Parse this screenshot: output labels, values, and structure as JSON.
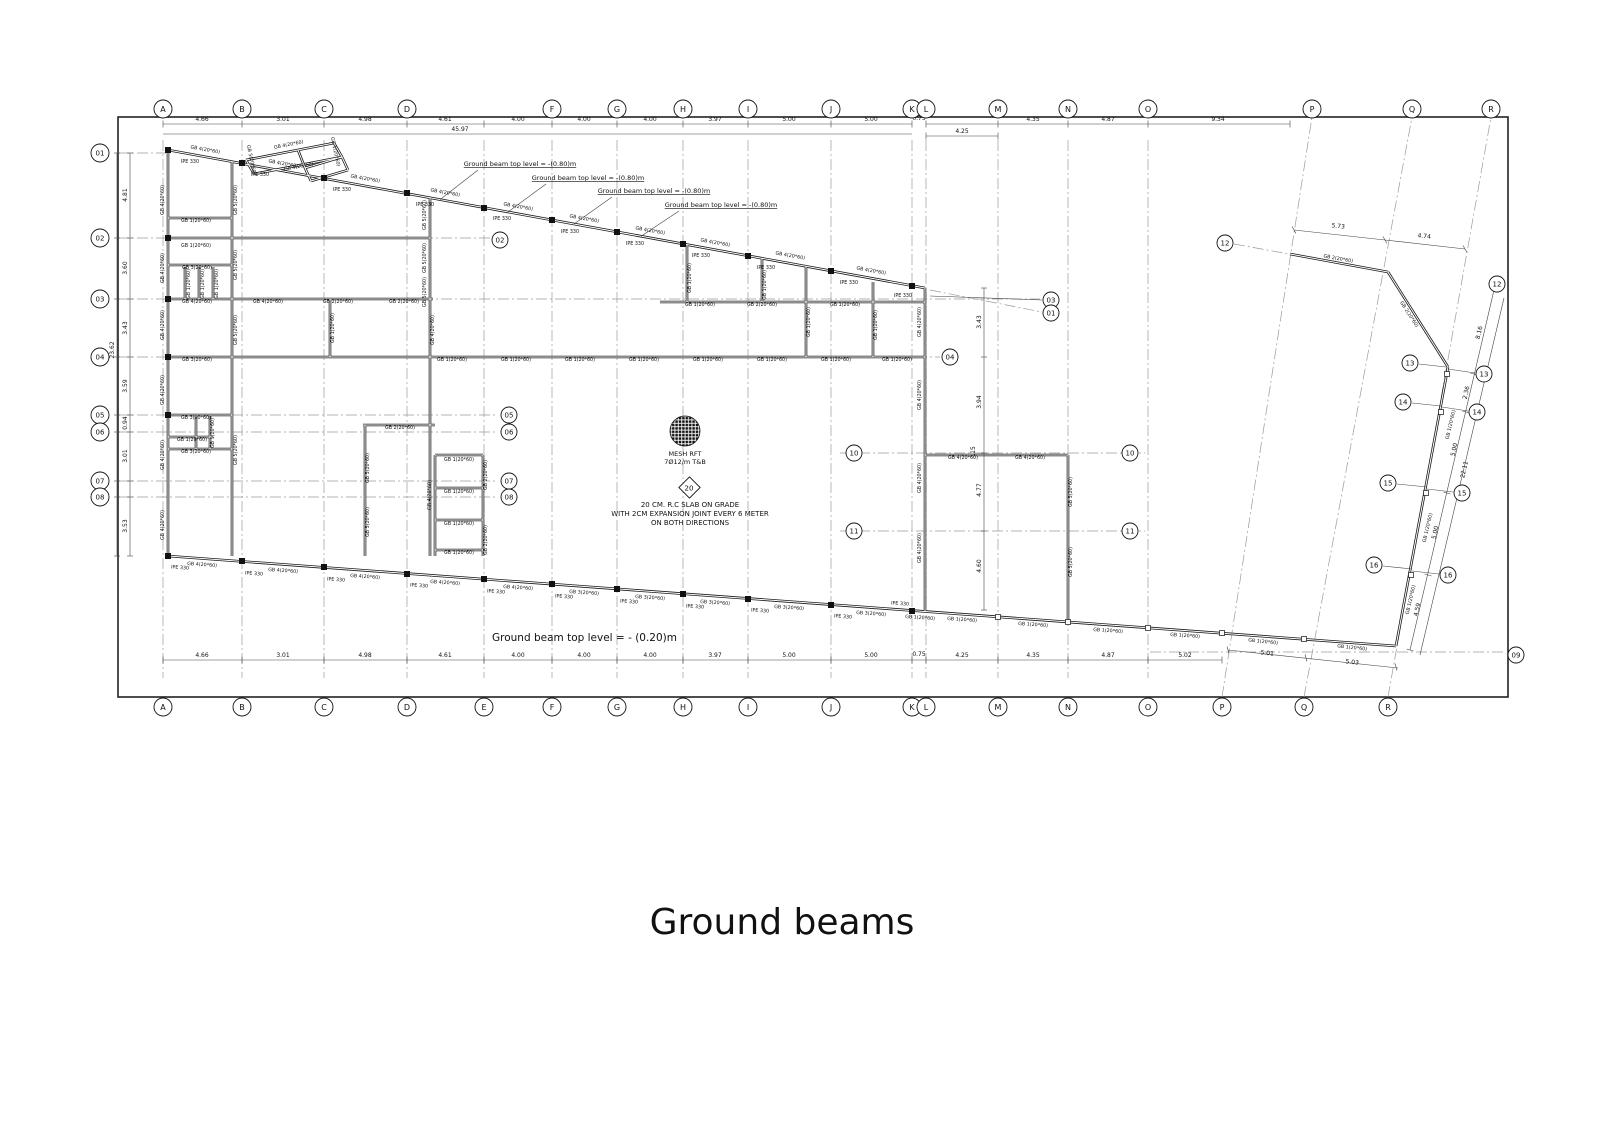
{
  "title": "Ground beams",
  "notes": {
    "top_level_note": "Ground beam top level = -(0.80)m",
    "top_level_note_positions": [
      [
        520,
        166
      ],
      [
        588,
        180
      ],
      [
        654,
        193
      ],
      [
        721,
        207
      ]
    ],
    "bottom_level_note": "Ground beam top level = - (0.20)m",
    "mesh_line1": "MESH RFT",
    "mesh_line2": "7Ø12/m T&B",
    "slab_marker": "20",
    "slab_line1": "20 CM. R.C SLAB ON GRADE",
    "slab_line2": "WITH 2CM EXPANSION JOINT EVERY 6 METER",
    "slab_line3": "ON BOTH DIRECTIONS"
  },
  "grid": {
    "cols_top": [
      [
        "A",
        163
      ],
      [
        "B",
        242
      ],
      [
        "C",
        324
      ],
      [
        "D",
        407
      ],
      [
        "F",
        552
      ],
      [
        "G",
        617
      ],
      [
        "H",
        683
      ],
      [
        "I",
        748
      ],
      [
        "J",
        831
      ],
      [
        "K",
        912
      ],
      [
        "L",
        926
      ],
      [
        "M",
        998
      ],
      [
        "N",
        1068
      ],
      [
        "O",
        1148
      ],
      [
        "P",
        1312
      ],
      [
        "Q",
        1412
      ],
      [
        "R",
        1491
      ]
    ],
    "cols_bottom": [
      [
        "A",
        163
      ],
      [
        "B",
        242
      ],
      [
        "C",
        324
      ],
      [
        "D",
        407
      ],
      [
        "E",
        484
      ],
      [
        "F",
        552
      ],
      [
        "G",
        617
      ],
      [
        "H",
        683
      ],
      [
        "I",
        748
      ],
      [
        "J",
        831
      ],
      [
        "K",
        912
      ],
      [
        "L",
        926
      ],
      [
        "M",
        998
      ],
      [
        "N",
        1068
      ],
      [
        "O",
        1148
      ],
      [
        "P",
        1222
      ],
      [
        "Q",
        1304
      ],
      [
        "R",
        1388
      ]
    ],
    "rows_left": [
      [
        "01",
        153
      ],
      [
        "02",
        238
      ],
      [
        "03",
        299
      ],
      [
        "04",
        357
      ],
      [
        "05",
        415
      ],
      [
        "06",
        432
      ],
      [
        "07",
        481
      ],
      [
        "08",
        497
      ]
    ],
    "bubbles": [
      [
        "02",
        500,
        240
      ],
      [
        "05",
        509,
        415
      ],
      [
        "06",
        509,
        432
      ],
      [
        "07",
        509,
        481
      ],
      [
        "08",
        509,
        497
      ],
      [
        "03",
        1051,
        300
      ],
      [
        "01",
        1051,
        313
      ],
      [
        "04",
        950,
        357
      ],
      [
        "10",
        854,
        453
      ],
      [
        "10",
        1130,
        453
      ],
      [
        "11",
        854,
        531
      ],
      [
        "11",
        1130,
        531
      ],
      [
        "12",
        1225,
        243
      ],
      [
        "12",
        1497,
        284
      ],
      [
        "13",
        1410,
        363
      ],
      [
        "13",
        1484,
        374
      ],
      [
        "14",
        1403,
        402
      ],
      [
        "14",
        1477,
        412
      ],
      [
        "15",
        1388,
        483
      ],
      [
        "15",
        1462,
        493
      ],
      [
        "16",
        1374,
        565
      ],
      [
        "16",
        1448,
        575
      ],
      [
        "09",
        1516,
        655
      ]
    ]
  },
  "dims": [
    [
      "4.66",
      202,
      121,
      0
    ],
    [
      "3.01",
      283,
      121,
      0
    ],
    [
      "4.98",
      365,
      121,
      0
    ],
    [
      "4.61",
      445,
      121,
      0
    ],
    [
      "4.00",
      518,
      121,
      0
    ],
    [
      "4.00",
      584,
      121,
      0
    ],
    [
      "4.00",
      650,
      121,
      0
    ],
    [
      "3.97",
      715,
      121,
      0
    ],
    [
      "5.00",
      789,
      121,
      0
    ],
    [
      "5.00",
      871,
      121,
      0
    ],
    [
      "0.75",
      919,
      120,
      0
    ],
    [
      "4.25",
      962,
      133,
      0
    ],
    [
      "4.35",
      1033,
      121,
      0
    ],
    [
      "4.87",
      1108,
      121,
      0
    ],
    [
      "9.34",
      1218,
      121,
      0
    ],
    [
      "45.97",
      460,
      131,
      0
    ],
    [
      "4.66",
      202,
      657,
      0
    ],
    [
      "3.01",
      283,
      657,
      0
    ],
    [
      "4.98",
      365,
      657,
      0
    ],
    [
      "4.61",
      445,
      657,
      0
    ],
    [
      "4.00",
      518,
      657,
      0
    ],
    [
      "4.00",
      584,
      657,
      0
    ],
    [
      "4.00",
      650,
      657,
      0
    ],
    [
      "3.97",
      715,
      657,
      0
    ],
    [
      "5.00",
      789,
      657,
      0
    ],
    [
      "5.00",
      871,
      657,
      0
    ],
    [
      "0.75",
      919,
      656,
      0
    ],
    [
      "4.25",
      962,
      657,
      0
    ],
    [
      "4.35",
      1033,
      657,
      0
    ],
    [
      "4.87",
      1108,
      657,
      0
    ],
    [
      "5.02",
      1185,
      657,
      0
    ],
    [
      "4.81",
      127,
      195,
      -90
    ],
    [
      "3.60",
      127,
      268,
      -90
    ],
    [
      "3.43",
      127,
      328,
      -90
    ],
    [
      "3.59",
      127,
      386,
      -90
    ],
    [
      "0.94",
      127,
      423,
      -90
    ],
    [
      "3.01",
      127,
      456,
      -90
    ],
    [
      "3.53",
      127,
      526,
      -90
    ],
    [
      "23.62",
      114,
      350,
      -90
    ],
    [
      "3.43",
      981,
      322,
      -90
    ],
    [
      "3.94",
      981,
      402,
      -90
    ],
    [
      ".15",
      975,
      451,
      -90
    ],
    [
      "4.77",
      981,
      490,
      -90
    ],
    [
      "4.60",
      981,
      566,
      -90
    ],
    [
      "5.73",
      1338,
      228,
      6
    ],
    [
      "4.74",
      1424,
      238,
      6
    ],
    [
      "8.16",
      1481,
      333,
      -77
    ],
    [
      "2.36",
      1468,
      393,
      -77
    ],
    [
      "5.00",
      1456,
      450,
      -77
    ],
    [
      "22.11",
      1466,
      470,
      -77
    ],
    [
      "5.00",
      1437,
      533,
      -77
    ],
    [
      "4.59",
      1419,
      610,
      -77
    ],
    [
      "5.01",
      1267,
      655,
      6
    ],
    [
      "5.03",
      1352,
      664,
      6
    ]
  ],
  "beam_labels": [
    [
      "GB 4(20*60)",
      205,
      151,
      10
    ],
    [
      "GB 4(20*60)",
      283,
      165,
      10
    ],
    [
      "GB 4(20*60)",
      365,
      180,
      10
    ],
    [
      "GB 4(20*60)",
      445,
      194,
      10
    ],
    [
      "GB 4(20*60)",
      518,
      208,
      10
    ],
    [
      "GB 4(20*60)",
      584,
      220,
      10
    ],
    [
      "GB 4(20*60)",
      650,
      232,
      10
    ],
    [
      "GB 4(20*60)",
      715,
      244,
      10
    ],
    [
      "GB 4(20*60)",
      790,
      257,
      10
    ],
    [
      "GB 4(20*60)",
      871,
      272,
      10
    ],
    [
      "IPE 330",
      190,
      163,
      0
    ],
    [
      "IPE 330",
      260,
      176,
      0
    ],
    [
      "IPE 330",
      342,
      191,
      0
    ],
    [
      "IPE 330",
      425,
      206,
      0
    ],
    [
      "IPE 330",
      502,
      220,
      0
    ],
    [
      "IPE 330",
      570,
      233,
      0
    ],
    [
      "IPE 330",
      635,
      245,
      0
    ],
    [
      "IPE 330",
      701,
      257,
      0
    ],
    [
      "IPE 330",
      766,
      269,
      0
    ],
    [
      "IPE 330",
      849,
      284,
      0
    ],
    [
      "IPE 330",
      903,
      297,
      0
    ],
    [
      "GB 4(20*60)",
      289,
      146,
      -11
    ],
    [
      "GB 4(20*60)",
      299,
      168,
      -11
    ],
    [
      "GB 5(20*60)",
      250,
      160,
      78
    ],
    [
      "GB 1(20*60)",
      334,
      152,
      78
    ],
    [
      "GB 4(20*60)",
      202,
      566,
      4
    ],
    [
      "GB 4(20*60)",
      283,
      572,
      4
    ],
    [
      "GB 4(20*60)",
      365,
      578,
      4
    ],
    [
      "GB 4(20*60)",
      445,
      584,
      4
    ],
    [
      "GB 4(20*60)",
      518,
      589,
      4
    ],
    [
      "GB 3(20*60)",
      584,
      594,
      4
    ],
    [
      "GB 3(20*60)",
      650,
      599,
      4
    ],
    [
      "GB 3(20*60)",
      715,
      604,
      4
    ],
    [
      "GB 3(20*60)",
      789,
      609,
      4
    ],
    [
      "GB 3(20*60)",
      871,
      615,
      4
    ],
    [
      "GB 1(20*60)",
      920,
      619,
      4
    ],
    [
      "GB 1(20*60)",
      962,
      621,
      4
    ],
    [
      "GB 1(20*60)",
      1033,
      626,
      4
    ],
    [
      "GB 1(20*60)",
      1108,
      632,
      4
    ],
    [
      "GB 1(20*60)",
      1185,
      637,
      4
    ],
    [
      "GB 1(20*60)",
      1263,
      643,
      6
    ],
    [
      "GB 1(20*60)",
      1352,
      649,
      6
    ],
    [
      "IPE 330",
      180,
      569,
      4
    ],
    [
      "IPE 330",
      254,
      575,
      4
    ],
    [
      "IPE 330",
      336,
      581,
      4
    ],
    [
      "IPE 330",
      419,
      587,
      4
    ],
    [
      "IPE 330",
      496,
      593,
      4
    ],
    [
      "IPE 330",
      564,
      598,
      4
    ],
    [
      "IPE 330",
      629,
      603,
      4
    ],
    [
      "IPE 330",
      695,
      608,
      4
    ],
    [
      "IPE 330",
      760,
      612,
      4
    ],
    [
      "IPE 330",
      843,
      618,
      4
    ],
    [
      "IPE 330",
      900,
      605,
      4
    ],
    [
      "GB 1(20*60)",
      196,
      222,
      0
    ],
    [
      "GB 1(20*60)",
      196,
      247,
      0
    ],
    [
      "GB 3(20*60)",
      197,
      269,
      0
    ],
    [
      "GB 4(20*60)",
      197,
      303,
      0
    ],
    [
      "GB 4(20*60)",
      268,
      303,
      0
    ],
    [
      "GB 2(20*60)",
      338,
      303,
      0
    ],
    [
      "GB 2(20*60)",
      404,
      303,
      0
    ],
    [
      "GB 3(20*60)",
      197,
      361,
      0
    ],
    [
      "GB 1(20*60)",
      452,
      361,
      0
    ],
    [
      "GB 1(20*60)",
      516,
      361,
      0
    ],
    [
      "GB 1(20*60)",
      580,
      361,
      0
    ],
    [
      "GB 1(20*60)",
      644,
      361,
      0
    ],
    [
      "GB 1(20*60)",
      708,
      361,
      0
    ],
    [
      "GB 1(20*60)",
      772,
      361,
      0
    ],
    [
      "GB 1(20*60)",
      836,
      361,
      0
    ],
    [
      "GB 1(20*60)",
      897,
      361,
      0
    ],
    [
      "GB 3(20*60)",
      196,
      419,
      0
    ],
    [
      "GB 1(20*60)",
      192,
      441,
      0
    ],
    [
      "GB 3(20*60)",
      196,
      453,
      0
    ],
    [
      "GB 4(20*60)",
      164,
      200,
      -90
    ],
    [
      "GB 4(20*60)",
      164,
      268,
      -90
    ],
    [
      "GB 4(20*60)",
      164,
      325,
      -90
    ],
    [
      "GB 4(20*60)",
      164,
      390,
      -90
    ],
    [
      "GB 4(20*60)",
      164,
      455,
      -90
    ],
    [
      "GB 4(20*60)",
      164,
      525,
      -90
    ],
    [
      "GB 5(20*60)",
      237,
      200,
      -90
    ],
    [
      "GB 5(20*60)",
      237,
      265,
      -90
    ],
    [
      "GB 5(20*60)",
      237,
      330,
      -90
    ],
    [
      "GB 5(20*60)",
      237,
      450,
      -90
    ],
    [
      "GB 5(20*60)",
      426,
      215,
      -90
    ],
    [
      "GB 5(20*60)",
      426,
      258,
      -90
    ],
    [
      "GB 5(20*60)",
      426,
      292,
      -90
    ],
    [
      "GB 4(20*60)",
      434,
      330,
      -90
    ],
    [
      "GB 1(20*60)",
      334,
      328,
      -90
    ],
    [
      "GB 5(20*60)",
      369,
      468,
      -90
    ],
    [
      "GB 5(20*60)",
      369,
      522,
      -90
    ],
    [
      "GB 4(20*60)",
      431,
      495,
      -90
    ],
    [
      "GB 2(20*60)",
      487,
      475,
      -90
    ],
    [
      "GB 2(20*60)",
      487,
      540,
      -90
    ],
    [
      "GB 1(20*60)",
      190,
      284,
      -90
    ],
    [
      "GB 1(20*60)",
      204,
      284,
      -90
    ],
    [
      "GB 1(20*60)",
      218,
      284,
      -90
    ],
    [
      "GB 1(20*60)",
      214,
      433,
      -90
    ],
    [
      "GB 4(20*60)",
      921,
      322,
      -90
    ],
    [
      "GB 4(20*60)",
      921,
      395,
      -90
    ],
    [
      "GB 4(20*60)",
      921,
      478,
      -90
    ],
    [
      "GB 4(20*60)",
      921,
      548,
      -90
    ],
    [
      "GB 1(20*60)",
      691,
      278,
      -90
    ],
    [
      "GB 1(20*60)",
      766,
      285,
      -90
    ],
    [
      "GB 1(20*60)",
      810,
      322,
      -90
    ],
    [
      "GB 1(20*60)",
      877,
      325,
      -90
    ],
    [
      "GB 5(20*60)",
      1072,
      492,
      -90
    ],
    [
      "GB 5(20*60)",
      1072,
      562,
      -90
    ],
    [
      "GB 1(20*60)",
      459,
      461,
      0
    ],
    [
      "GB 1(20*60)",
      459,
      493,
      0
    ],
    [
      "GB 1(20*60)",
      459,
      525,
      0
    ],
    [
      "GB 1(20*60)",
      459,
      554,
      0
    ],
    [
      "GB 2(20*60)",
      400,
      429,
      0
    ],
    [
      "GB 1(20*60)",
      700,
      306,
      0
    ],
    [
      "GB 2(20*60)",
      762,
      306,
      0
    ],
    [
      "GB 1(20*60)",
      845,
      306,
      0
    ],
    [
      "GB 4(20*60)",
      963,
      459,
      0
    ],
    [
      "GB 4(20*60)",
      1030,
      459,
      0
    ],
    [
      "GB 2(20*60)",
      1338,
      260,
      10
    ],
    [
      "GB 2(20*60)",
      1408,
      315,
      57
    ],
    [
      "GB 1(20*60)",
      1452,
      425,
      -77
    ],
    [
      "GB 1(20*60)",
      1429,
      528,
      -77
    ],
    [
      "GB 1(20*60)",
      1412,
      600,
      -77
    ]
  ]
}
